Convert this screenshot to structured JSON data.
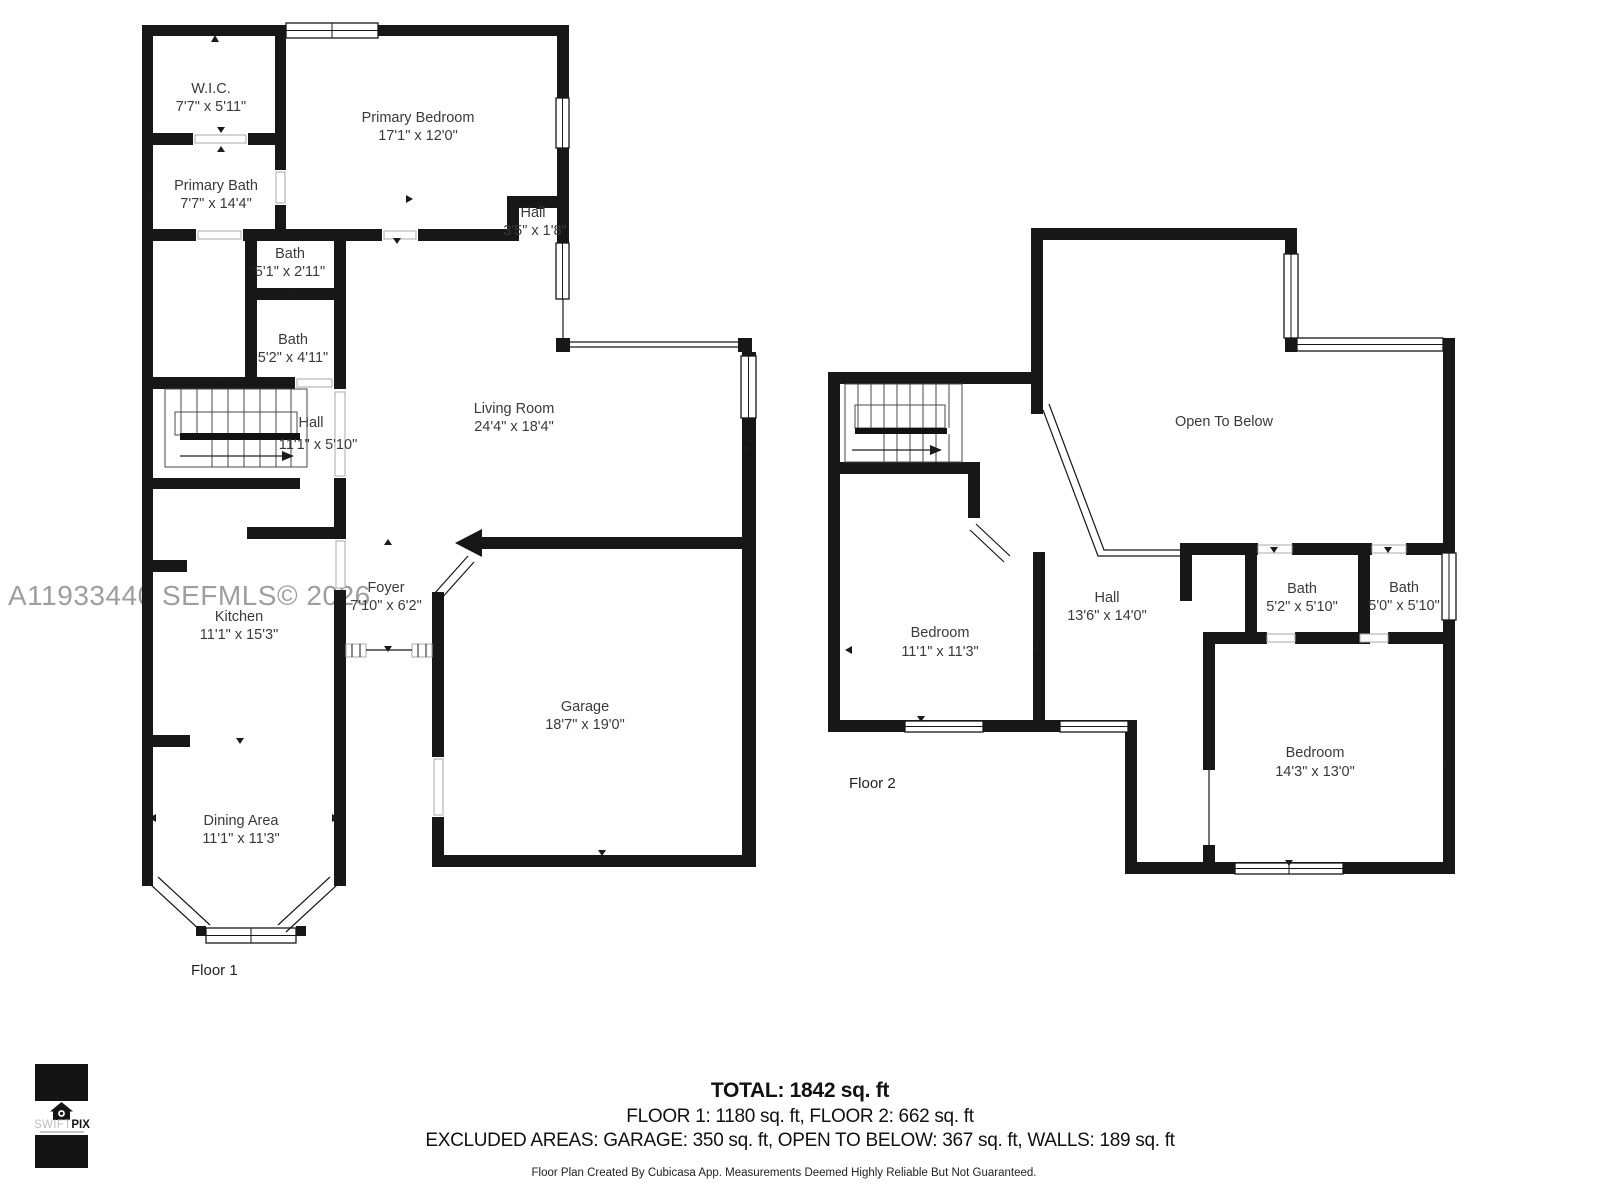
{
  "watermark": "A11933440 SEFMLS© 2026",
  "floor1": {
    "label": "Floor 1",
    "rooms": [
      {
        "name": "W.I.C.",
        "dims": "7'7\" x 5'11\""
      },
      {
        "name": "Primary Bath",
        "dims": "7'7\" x 14'4\""
      },
      {
        "name": "Primary Bedroom",
        "dims": "17'1\" x 12'0\""
      },
      {
        "name": "Hall",
        "dims": "3'5\" x 1'8\""
      },
      {
        "name": "Bath",
        "dims": "5'1\" x 2'11\""
      },
      {
        "name": "Bath",
        "dims": "5'2\" x 4'11\""
      },
      {
        "name": "Hall",
        "dims": "11'1\" x 5'10\""
      },
      {
        "name": "Living Room",
        "dims": "24'4\" x 18'4\""
      },
      {
        "name": "Kitchen",
        "dims": "11'1\" x 15'3\""
      },
      {
        "name": "Foyer",
        "dims": "7'10\" x 6'2\""
      },
      {
        "name": "Garage",
        "dims": "18'7\" x 19'0\""
      },
      {
        "name": "Dining Area",
        "dims": "11'1\" x 11'3\""
      }
    ]
  },
  "floor2": {
    "label": "Floor 2",
    "rooms": [
      {
        "name": "Open To Below",
        "dims": ""
      },
      {
        "name": "Bedroom",
        "dims": "11'1\" x 11'3\""
      },
      {
        "name": "Hall",
        "dims": "13'6\" x 14'0\""
      },
      {
        "name": "Bath",
        "dims": "5'2\" x 5'10\""
      },
      {
        "name": "Bath",
        "dims": "5'0\" x 5'10\""
      },
      {
        "name": "Bedroom",
        "dims": "14'3\" x 13'0\""
      }
    ]
  },
  "summary": {
    "total": "TOTAL: 1842 sq. ft",
    "floors": "FLOOR 1: 1180 sq. ft, FLOOR 2: 662 sq. ft",
    "excluded": "EXCLUDED AREAS: GARAGE: 350 sq. ft, OPEN TO BELOW: 367 sq. ft, WALLS: 189 sq. ft"
  },
  "footer": "Floor Plan Created By Cubicasa App. Measurements Deemed Highly Reliable But Not Guaranteed.",
  "logo": {
    "swift": "SWIFT",
    "pix": "PIX"
  }
}
